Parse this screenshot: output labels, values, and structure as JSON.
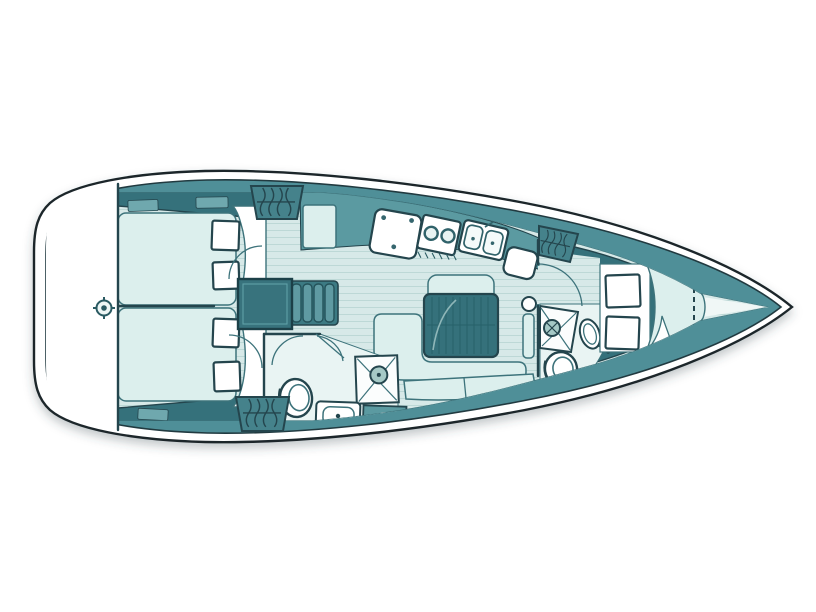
{
  "meta": {
    "title": "Sailing yacht interior layout plan, top-down view, bow pointing right",
    "canvas": {
      "width": 816,
      "height": 612
    }
  },
  "colors": {
    "page_bg": "#ffffff",
    "hull_stroke": "#1c262b",
    "deck": "#4f8f98",
    "dark": "#35717b",
    "med": "#5b9aa1",
    "med_light": "#6fa8ae",
    "floor": "#d7e9e8",
    "plank": "#bdd8d6",
    "light": "#dcefed",
    "room": "#e9f4f3",
    "white": "#ffffff",
    "line_dark": "#24454d",
    "line_mid": "#3d737b",
    "fixture_teal": "#a5c9c6"
  },
  "vessel": {
    "type": "monohull sailing yacht floor plan",
    "view": "top-down interior layout",
    "orientation": "bow to the right, stern to the left",
    "rooms": [
      {
        "name": "stern-platform",
        "fixtures": [
          "steering-gear-fitting"
        ]
      },
      {
        "name": "aft-cabin-port",
        "fixtures": [
          "double-berth",
          "pillow-area",
          "storage-shelf",
          "hanging-locker",
          "cushion-hatches"
        ]
      },
      {
        "name": "aft-cabin-starboard",
        "fixtures": [
          "double-berth",
          "pillow-area",
          "storage-shelf",
          "hanging-locker",
          "cushion-hatches"
        ]
      },
      {
        "name": "companionway",
        "fixtures": [
          "engine-box",
          "companionway-steps",
          "doors"
        ]
      },
      {
        "name": "galley",
        "fixtures": [
          "counter-module",
          "icebox",
          "two-burner-stove",
          "double-sink",
          "end-counter"
        ]
      },
      {
        "name": "salon",
        "fixtures": [
          "folding-table",
          "l-settee",
          "seat-back",
          "bench-cushions",
          "mast-post"
        ]
      },
      {
        "name": "aft-head",
        "fixtures": [
          "toilet",
          "wash-basin",
          "shower",
          "locker",
          "double-doors"
        ]
      },
      {
        "name": "forward-head",
        "fixtures": [
          "shower",
          "wash-basin",
          "toilet",
          "steps"
        ]
      },
      {
        "name": "forward-cabin",
        "fixtures": [
          "v-berth",
          "pillow-area",
          "cushion-hatches",
          "hanging-locker",
          "anchor-locker-dashed-line"
        ]
      }
    ]
  }
}
